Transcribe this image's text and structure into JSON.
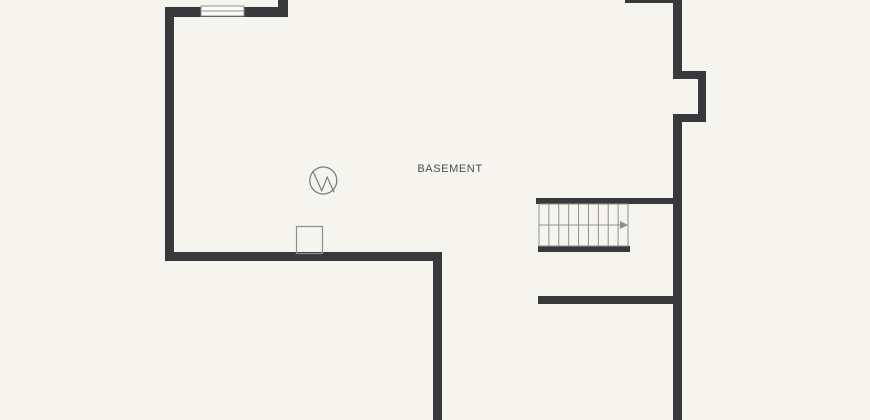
{
  "canvas": {
    "width": 870,
    "height": 420,
    "background": "#f5f4ee"
  },
  "colors": {
    "wall": "#39393b",
    "thin_line": "#8f8f8f",
    "symbol_line": "#7d7d7d",
    "window_fill": "#fcfcfa",
    "label_text": "#4e4e4e"
  },
  "room": {
    "label": "BASEMENT"
  },
  "floorplan": {
    "walls": [
      {
        "name": "top-wall",
        "x": 165,
        "y": 7,
        "w": 123,
        "h": 10
      },
      {
        "name": "top-wall-stub-up",
        "x": 278,
        "y": 0,
        "w": 10,
        "h": 17
      },
      {
        "name": "left-wall",
        "x": 165,
        "y": 7,
        "w": 9,
        "h": 254
      },
      {
        "name": "left-room-bottom-wall",
        "x": 165,
        "y": 252,
        "w": 277,
        "h": 9
      },
      {
        "name": "center-vertical-wall",
        "x": 433,
        "y": 252,
        "w": 9,
        "h": 168
      },
      {
        "name": "top-right-wall-sliver",
        "x": 625,
        "y": 0,
        "w": 57,
        "h": 3
      },
      {
        "name": "right-wall-upper",
        "x": 673,
        "y": 0,
        "w": 9,
        "h": 79
      },
      {
        "name": "chimney-bump-top",
        "x": 673,
        "y": 71,
        "w": 33,
        "h": 8
      },
      {
        "name": "chimney-bump-right",
        "x": 698,
        "y": 71,
        "w": 8,
        "h": 51
      },
      {
        "name": "chimney-bump-bottom",
        "x": 673,
        "y": 114,
        "w": 33,
        "h": 8
      },
      {
        "name": "right-wall-lower",
        "x": 673,
        "y": 114,
        "w": 9,
        "h": 306
      },
      {
        "name": "stairwell-top-wall",
        "x": 536,
        "y": 198,
        "w": 137,
        "h": 6
      },
      {
        "name": "stairwell-bottom-wall",
        "x": 538,
        "y": 246,
        "w": 92,
        "h": 6
      },
      {
        "name": "lower-right-partition-wall",
        "x": 538,
        "y": 296,
        "w": 136,
        "h": 8
      }
    ],
    "window": {
      "x": 201,
      "y": 6,
      "w": 43,
      "h": 10
    },
    "stairs": {
      "x": 539,
      "y": 204,
      "w": 89,
      "h": 42,
      "tread_count": 9,
      "direction_arrow": "right"
    },
    "symbols": [
      {
        "type": "utility-circle",
        "cx": 323.3,
        "cy": 180.5,
        "r": 13.5,
        "zigzag": [
          [
            312.7,
            170.7
          ],
          [
            321.7,
            190.7
          ],
          [
            327.3,
            177.3
          ],
          [
            334,
            192.3
          ]
        ]
      },
      {
        "type": "support-post",
        "x": 296.5,
        "y": 226.5,
        "w": 26,
        "h": 27
      }
    ]
  }
}
